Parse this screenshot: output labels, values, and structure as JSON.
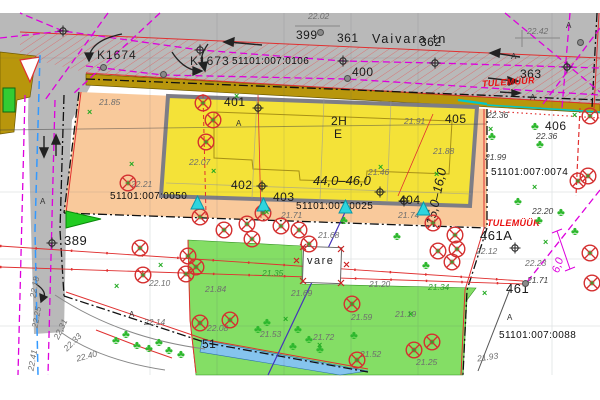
{
  "map": {
    "street_name": "Vaivara tn",
    "colors": {
      "road_gray": "#b9b9b9",
      "sidewalk_olive": "#b8960c",
      "plot_orange": "#f9c99b",
      "building_yellow": "#f4e238",
      "building_border_gray": "#7d7d86",
      "green_area": "#6fd84a",
      "water_blue": "#85c4ee",
      "utility_magenta": "#dd00dd",
      "boundary_red": "#e03030",
      "firewall_red": "#e81010",
      "entrance_cyan": "#2fd4de",
      "survey_blue_dashed": "#3399ff"
    },
    "labels": [
      {
        "t": "22.02",
        "x": 308,
        "y": 12,
        "c": "elev"
      },
      {
        "t": "399",
        "x": 296,
        "y": 29,
        "c": "num"
      },
      {
        "t": "361",
        "x": 337,
        "y": 32,
        "c": "num"
      },
      {
        "t": "Vaivara tn",
        "x": 372,
        "y": 33,
        "c": "street"
      },
      {
        "t": "362",
        "x": 420,
        "y": 36,
        "c": "num"
      },
      {
        "t": "K1674",
        "x": 97,
        "y": 49,
        "c": "pn2"
      },
      {
        "t": "K1673",
        "x": 190,
        "y": 55,
        "c": "pn2"
      },
      {
        "t": "51101:007:0106",
        "x": 232,
        "y": 57,
        "c": "pn"
      },
      {
        "t": "400",
        "x": 352,
        "y": 66,
        "c": "num"
      },
      {
        "t": "22.42",
        "x": 527,
        "y": 27,
        "c": "elev"
      },
      {
        "t": "363",
        "x": 520,
        "y": 68,
        "c": "num"
      },
      {
        "t": "TULEMÜÜR",
        "x": 482,
        "y": 78,
        "c": "fire",
        "r": -4
      },
      {
        "t": "401",
        "x": 224,
        "y": 96,
        "c": "num"
      },
      {
        "t": "21.85",
        "x": 99,
        "y": 98,
        "c": "elev"
      },
      {
        "t": "405",
        "x": 445,
        "y": 113,
        "c": "num"
      },
      {
        "t": "22.36",
        "x": 487,
        "y": 111,
        "c": "elev2"
      },
      {
        "t": "406",
        "x": 545,
        "y": 120,
        "c": "num"
      },
      {
        "t": "22.36",
        "x": 536,
        "y": 132,
        "c": "elev2"
      },
      {
        "t": "2H",
        "x": 331,
        "y": 115,
        "c": "num"
      },
      {
        "t": "E",
        "x": 334,
        "y": 128,
        "c": "num"
      },
      {
        "t": "21.91",
        "x": 404,
        "y": 117,
        "c": "elev"
      },
      {
        "t": "A",
        "x": 236,
        "y": 120,
        "c": "amark"
      },
      {
        "t": "21.88",
        "x": 433,
        "y": 147,
        "c": "elev"
      },
      {
        "t": "15,0–16,0",
        "x": 407,
        "y": 190,
        "c": "dim",
        "r": -78
      },
      {
        "t": "21.99",
        "x": 485,
        "y": 153,
        "c": "elev2"
      },
      {
        "t": "51101:007:0074",
        "x": 491,
        "y": 168,
        "c": "pn"
      },
      {
        "t": "22.07",
        "x": 189,
        "y": 158,
        "c": "elev"
      },
      {
        "t": "21.46",
        "x": 368,
        "y": 168,
        "c": "elev"
      },
      {
        "t": "44,0–46,0",
        "x": 313,
        "y": 174,
        "c": "dim"
      },
      {
        "t": "22.21",
        "x": 131,
        "y": 180,
        "c": "elev"
      },
      {
        "t": "402",
        "x": 231,
        "y": 179,
        "c": "num"
      },
      {
        "t": "403",
        "x": 273,
        "y": 191,
        "c": "num"
      },
      {
        "t": "404",
        "x": 399,
        "y": 194,
        "c": "num"
      },
      {
        "t": "51101:007:0050",
        "x": 110,
        "y": 192,
        "c": "pn"
      },
      {
        "t": "51101:007:0025",
        "x": 296,
        "y": 202,
        "c": "pn"
      },
      {
        "t": "21.71",
        "x": 281,
        "y": 211,
        "c": "elev"
      },
      {
        "t": "21.74",
        "x": 398,
        "y": 211,
        "c": "elev"
      },
      {
        "t": "TULEMÜÜR",
        "x": 487,
        "y": 219,
        "c": "fire"
      },
      {
        "t": "22.20",
        "x": 532,
        "y": 207,
        "c": "elev2"
      },
      {
        "t": "389",
        "x": 64,
        "y": 234,
        "c": "num2"
      },
      {
        "t": "21.68",
        "x": 318,
        "y": 231,
        "c": "elev"
      },
      {
        "t": "461A",
        "x": 480,
        "y": 229,
        "c": "num2"
      },
      {
        "t": "22.12",
        "x": 476,
        "y": 247,
        "c": "elev"
      },
      {
        "t": "6,0",
        "x": 551,
        "y": 260,
        "c": "magdim",
        "r": -72
      },
      {
        "t": "vare",
        "x": 307,
        "y": 256,
        "c": "vare"
      },
      {
        "t": "21.35",
        "x": 262,
        "y": 269,
        "c": "elevg"
      },
      {
        "t": "22.23",
        "x": 525,
        "y": 259,
        "c": "elev"
      },
      {
        "t": "21.71",
        "x": 527,
        "y": 276,
        "c": "elev2"
      },
      {
        "t": "461",
        "x": 506,
        "y": 282,
        "c": "num2"
      },
      {
        "t": "21.34",
        "x": 428,
        "y": 283,
        "c": "elevg"
      },
      {
        "t": "21.84",
        "x": 205,
        "y": 285,
        "c": "elev"
      },
      {
        "t": "21.20",
        "x": 369,
        "y": 280,
        "c": "elev"
      },
      {
        "t": "21.69",
        "x": 291,
        "y": 289,
        "c": "elev"
      },
      {
        "t": "22.10",
        "x": 149,
        "y": 279,
        "c": "elev"
      },
      {
        "t": "22.14",
        "x": 144,
        "y": 318,
        "c": "elev"
      },
      {
        "t": "22.08",
        "x": 207,
        "y": 324,
        "c": "elev"
      },
      {
        "t": "21.53",
        "x": 260,
        "y": 330,
        "c": "elev"
      },
      {
        "t": "21.59",
        "x": 351,
        "y": 313,
        "c": "elev"
      },
      {
        "t": "21.19",
        "x": 395,
        "y": 310,
        "c": "elev"
      },
      {
        "t": "21.72",
        "x": 313,
        "y": 333,
        "c": "elev"
      },
      {
        "t": "21.52",
        "x": 360,
        "y": 350,
        "c": "elev"
      },
      {
        "t": "21.25",
        "x": 416,
        "y": 358,
        "c": "elev"
      },
      {
        "t": "51",
        "x": 202,
        "y": 338,
        "c": "num"
      },
      {
        "t": "51101:007:0088",
        "x": 499,
        "y": 331,
        "c": "pn"
      },
      {
        "t": "21.93",
        "x": 477,
        "y": 353,
        "c": "elev",
        "r": -8
      },
      {
        "t": "22.18",
        "x": 24,
        "y": 283,
        "c": "elev",
        "r": -80
      },
      {
        "t": "22.25",
        "x": 26,
        "y": 313,
        "c": "elev",
        "r": -80
      },
      {
        "t": "22.41",
        "x": 22,
        "y": 356,
        "c": "elev",
        "r": -80
      },
      {
        "t": "22.31",
        "x": 50,
        "y": 325,
        "c": "elev",
        "r": -65
      },
      {
        "t": "22.33",
        "x": 62,
        "y": 338,
        "c": "elev",
        "r": -45
      },
      {
        "t": "22.40",
        "x": 76,
        "y": 352,
        "c": "elev",
        "r": -15
      },
      {
        "t": "A",
        "x": 511,
        "y": 53,
        "c": "amark"
      },
      {
        "t": "A",
        "x": 566,
        "y": 22,
        "c": "amark"
      },
      {
        "t": "A",
        "x": 530,
        "y": 94,
        "c": "amark"
      },
      {
        "t": "A",
        "x": 40,
        "y": 198,
        "c": "amark"
      },
      {
        "t": "A",
        "x": 507,
        "y": 314,
        "c": "amark"
      },
      {
        "t": "A",
        "x": 129,
        "y": 311,
        "c": "amark"
      }
    ],
    "trees": [
      [
        493,
        136
      ],
      [
        536,
        126
      ],
      [
        541,
        144
      ],
      [
        519,
        201
      ],
      [
        540,
        220
      ],
      [
        562,
        212
      ],
      [
        576,
        231
      ],
      [
        427,
        265
      ],
      [
        299,
        329
      ],
      [
        310,
        339
      ],
      [
        294,
        346
      ],
      [
        321,
        349
      ],
      [
        268,
        322
      ],
      [
        259,
        329
      ],
      [
        117,
        340
      ],
      [
        127,
        334
      ],
      [
        138,
        345
      ],
      [
        150,
        348
      ],
      [
        160,
        342
      ],
      [
        170,
        350
      ],
      [
        182,
        354
      ],
      [
        355,
        335
      ],
      [
        398,
        236
      ],
      [
        345,
        220
      ]
    ],
    "removed_trees": [
      [
        203,
        103
      ],
      [
        213,
        120
      ],
      [
        206,
        142
      ],
      [
        128,
        183
      ],
      [
        200,
        217
      ],
      [
        224,
        230
      ],
      [
        247,
        224
      ],
      [
        252,
        239
      ],
      [
        263,
        213
      ],
      [
        281,
        226
      ],
      [
        299,
        230
      ],
      [
        309,
        244
      ],
      [
        140,
        248
      ],
      [
        143,
        275
      ],
      [
        188,
        256
      ],
      [
        196,
        267
      ],
      [
        186,
        274
      ],
      [
        433,
        223
      ],
      [
        455,
        235
      ],
      [
        438,
        251
      ],
      [
        457,
        249
      ],
      [
        452,
        262
      ],
      [
        352,
        304
      ],
      [
        200,
        323
      ],
      [
        230,
        320
      ],
      [
        357,
        360
      ],
      [
        414,
        350
      ],
      [
        432,
        342
      ],
      [
        590,
        116
      ],
      [
        588,
        176
      ],
      [
        590,
        253
      ],
      [
        592,
        283
      ],
      [
        578,
        181
      ]
    ],
    "manholes": [
      [
        320,
        32
      ],
      [
        347,
        78
      ],
      [
        163,
        74
      ],
      [
        103,
        67
      ],
      [
        580,
        42
      ],
      [
        525,
        283
      ]
    ],
    "benchmarks": [
      [
        63,
        30
      ],
      [
        200,
        49
      ],
      [
        343,
        60
      ],
      [
        435,
        62
      ],
      [
        567,
        66
      ],
      [
        515,
        247
      ],
      [
        52,
        242
      ],
      [
        258,
        107
      ],
      [
        262,
        185
      ],
      [
        380,
        191
      ],
      [
        404,
        200
      ]
    ],
    "entrances": [
      [
        197,
        208
      ],
      [
        263,
        210
      ],
      [
        345,
        212
      ],
      [
        423,
        214
      ]
    ],
    "green_marks": [
      [
        91,
        112
      ],
      [
        133,
        164
      ],
      [
        215,
        171
      ],
      [
        268,
        212
      ],
      [
        576,
        115
      ],
      [
        492,
        129
      ],
      [
        547,
        242
      ],
      [
        486,
        293
      ],
      [
        412,
        314
      ],
      [
        321,
        345
      ],
      [
        162,
        265
      ],
      [
        287,
        319
      ],
      [
        118,
        286
      ],
      [
        438,
        174
      ],
      [
        382,
        167
      ],
      [
        238,
        96
      ],
      [
        536,
        187
      ]
    ]
  }
}
